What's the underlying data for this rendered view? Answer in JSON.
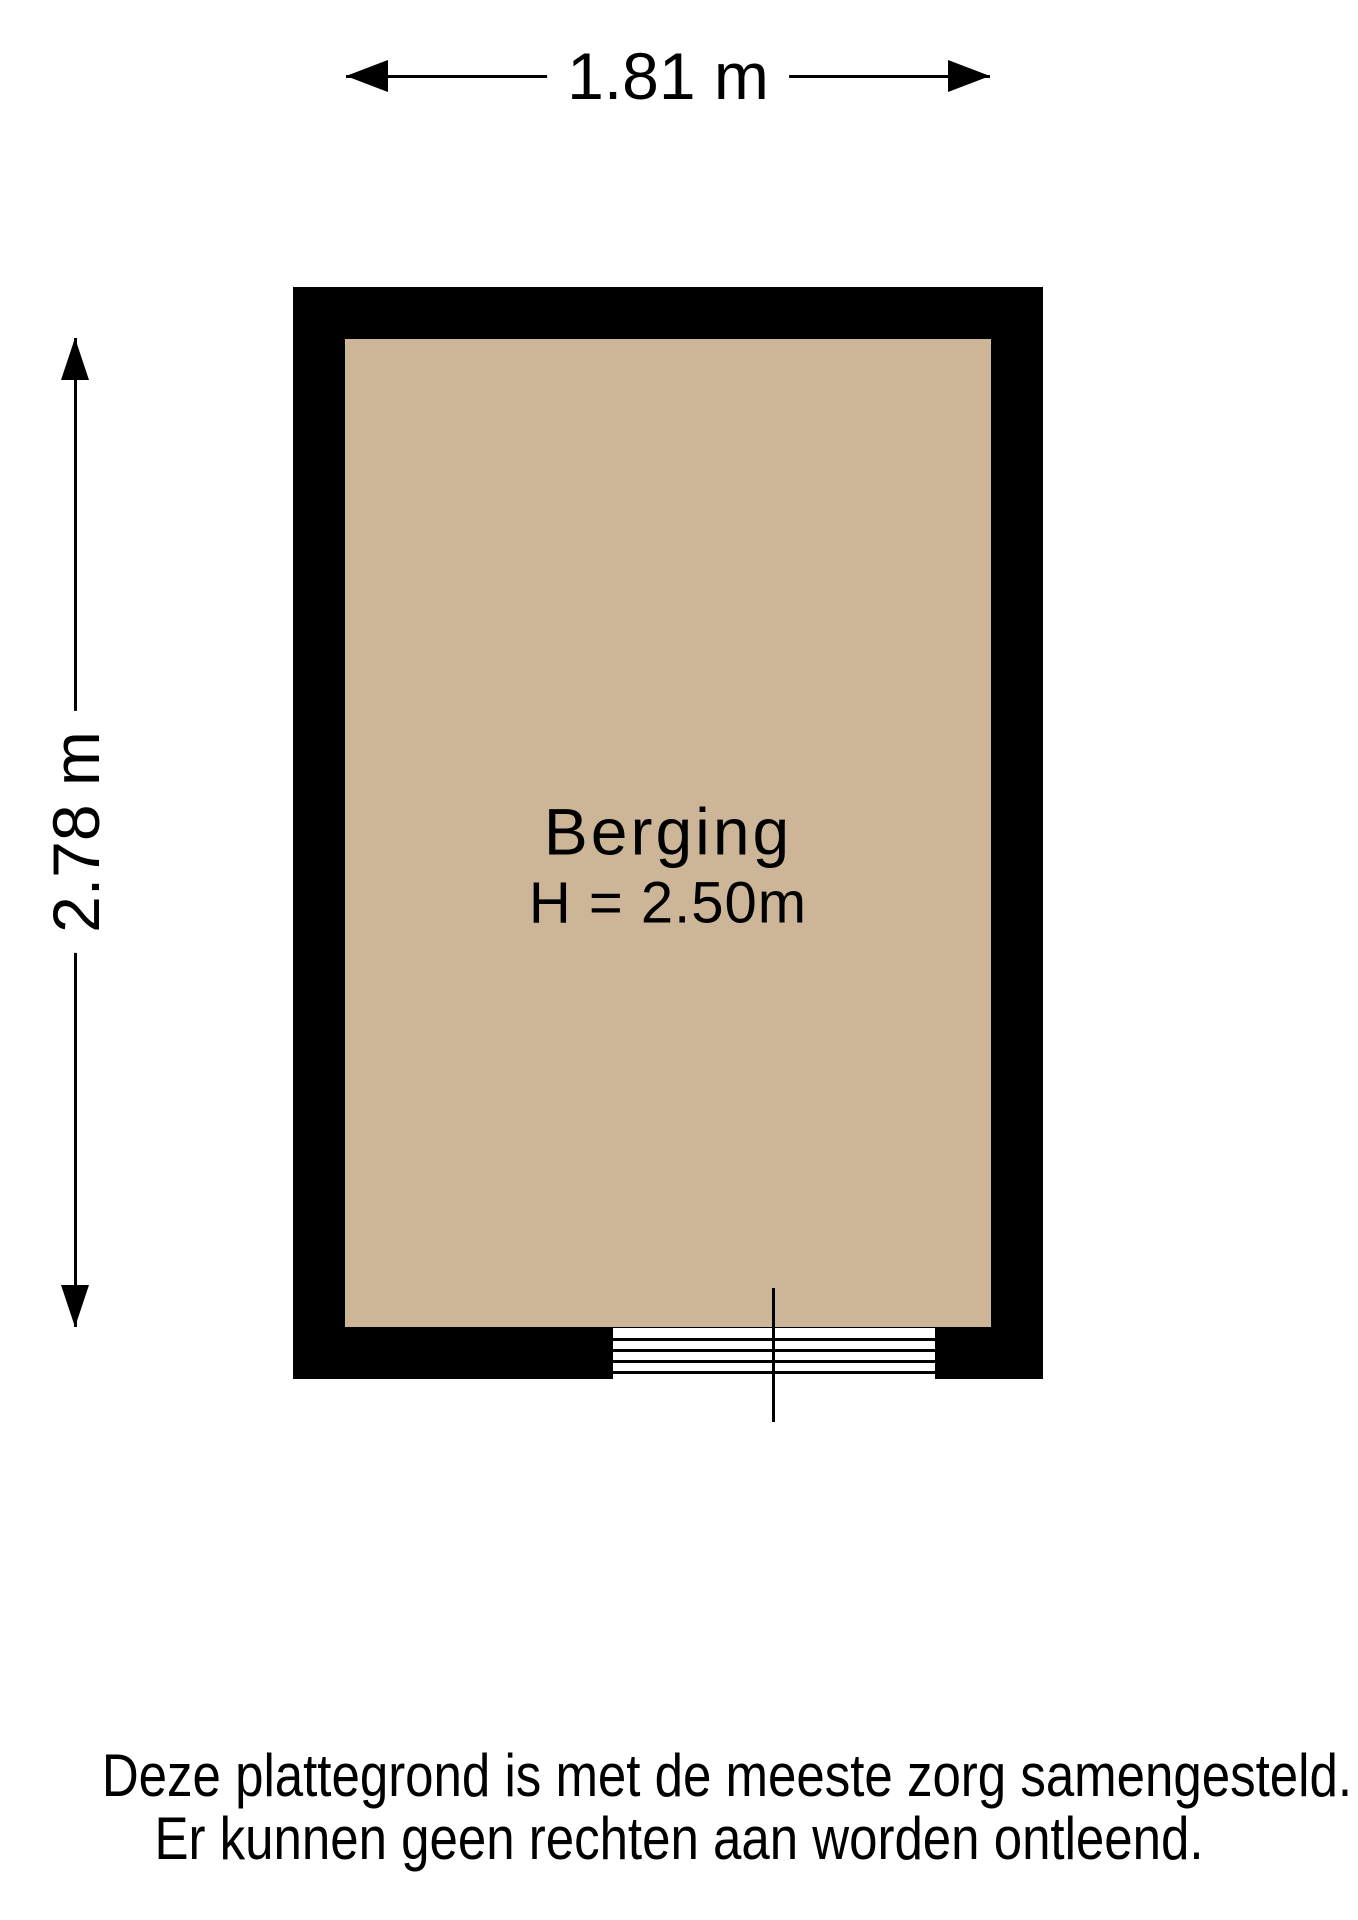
{
  "floorplan": {
    "dimensions": {
      "width_label": "1.81 m",
      "height_label": "2.78 m"
    },
    "room": {
      "name": "Berging",
      "ceiling_height_label": "H = 2.50m"
    },
    "colors": {
      "floor": "#CDB697",
      "wall": "#000000",
      "background": "#ffffff"
    }
  },
  "disclaimer": {
    "line1": "Deze plattegrond is met de meeste zorg samengesteld.",
    "line2": "Er kunnen geen rechten aan worden ontleend."
  }
}
